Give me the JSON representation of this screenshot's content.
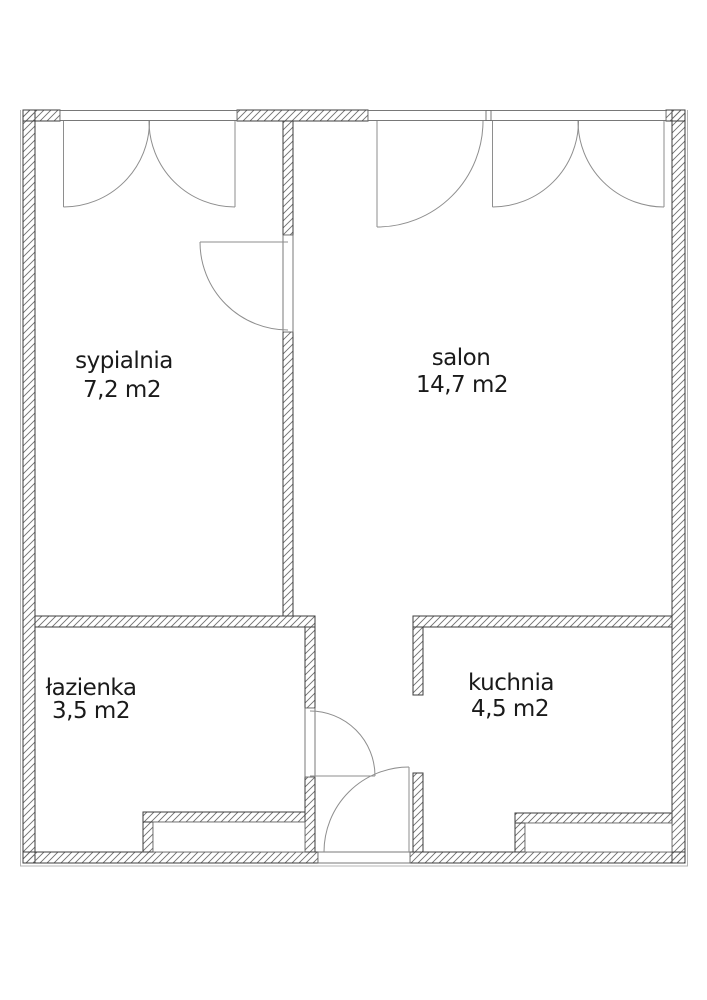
{
  "rooms": {
    "sypialnia": {
      "name": "sypialnia",
      "area": "7,2 m2"
    },
    "salon": {
      "name": "salon",
      "area": "14,7 m2"
    },
    "lazienka": {
      "name": "łazienka",
      "area": "3,5 m2"
    },
    "kuchnia": {
      "name": "kuchnia",
      "area": "4,5 m2"
    }
  },
  "colors": {
    "wall_outline": "#3d3d3d",
    "hatch": "#6f6f6f",
    "frame": "#6a6a6a",
    "swing": "#8e8e8e",
    "text": "#1a1a1a",
    "boundary": "#b5b5b5"
  }
}
